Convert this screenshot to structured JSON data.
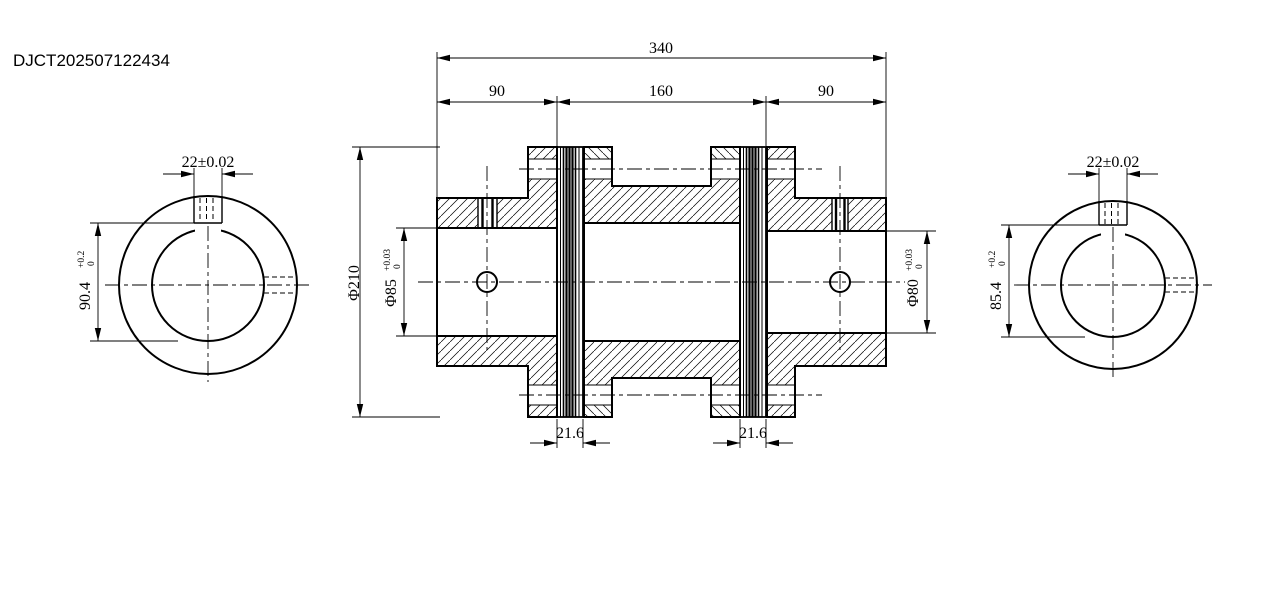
{
  "title": "DJCT202507122434",
  "section_view": {
    "overall_length": "340",
    "left_hub_length": "90",
    "middle_length": "160",
    "right_hub_length": "90",
    "flange_diameter": "Φ210",
    "left_bore": {
      "value": "Φ85",
      "tol_upper": "+0.03",
      "tol_lower": "0"
    },
    "right_bore": {
      "value": "Φ80",
      "tol_upper": "+0.03",
      "tol_lower": "0"
    },
    "left_disc_pack_width": "21.6",
    "right_disc_pack_width": "21.6"
  },
  "left_end_view": {
    "keyway_width": "22±0.02",
    "bore_keyway_dim": {
      "value": "90.4",
      "tol_upper": "+0.2",
      "tol_lower": "0"
    }
  },
  "right_end_view": {
    "keyway_width": "22±0.02",
    "bore_keyway_dim": {
      "value": "85.4",
      "tol_upper": "+0.2",
      "tol_lower": "0"
    }
  }
}
